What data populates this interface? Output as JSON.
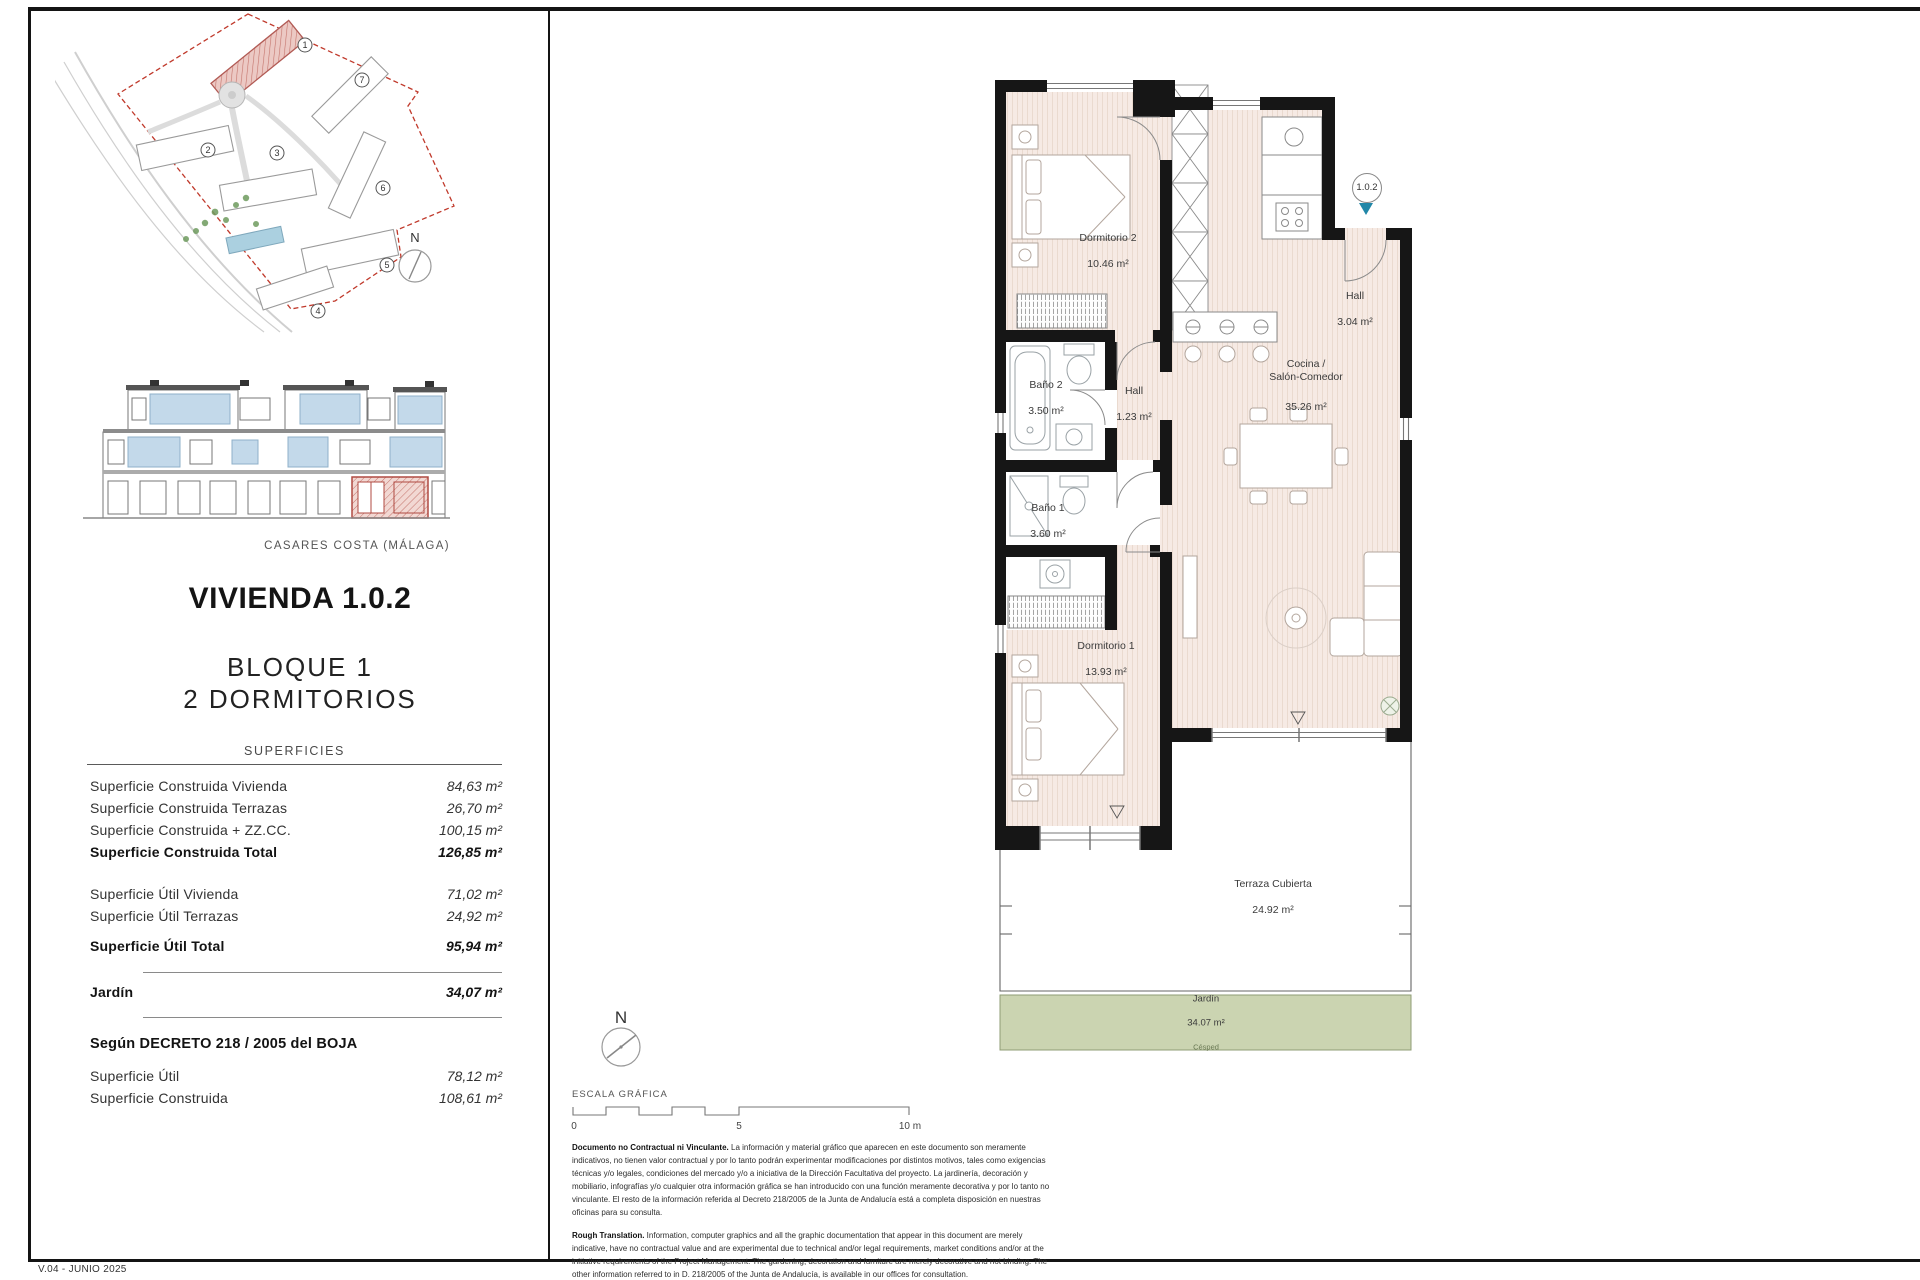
{
  "page": {
    "location": "CASARES COSTA (MÁLAGA)",
    "version": "V.04 - JUNIO 2025"
  },
  "title": {
    "unit": "VIVIENDA 1.0.2",
    "block": "BLOQUE 1",
    "type": "2 DORMITORIOS"
  },
  "surfaces": {
    "header": "SUPERFICIES",
    "construida": [
      {
        "label": "Superficie Construida Vivienda",
        "value": "84,63 m²"
      },
      {
        "label": "Superficie Construida Terrazas",
        "value": "26,70 m²"
      },
      {
        "label": "Superficie Construida + ZZ.CC.",
        "value": "100,15 m²"
      },
      {
        "label": "Superficie Construida Total",
        "value": "126,85 m²"
      }
    ],
    "util": [
      {
        "label": "Superficie Útil Vivienda",
        "value": "71,02 m²"
      },
      {
        "label": "Superficie Útil Terrazas",
        "value": "24,92 m²"
      },
      {
        "label": "Superficie Útil Total",
        "value": "95,94 m²"
      }
    ],
    "jardin": {
      "label": "Jardín",
      "value": "34,07 m²"
    },
    "decree": {
      "header": "Según DECRETO 218 / 2005 del BOJA",
      "rows": [
        {
          "label": "Superficie Útil",
          "value": "78,12 m²"
        },
        {
          "label": "Superficie Construida",
          "value": "108,61 m²"
        }
      ]
    }
  },
  "site_plan": {
    "north": "N",
    "numbers": [
      "1",
      "2",
      "3",
      "4",
      "5",
      "6",
      "7"
    ]
  },
  "floor_plan": {
    "marker": "1.0.2",
    "north": "N",
    "rooms": {
      "dormitorio2": {
        "name": "Dormitorio 2",
        "area": "10.46 m²"
      },
      "bano2": {
        "name": "Baño 2",
        "area": "3.50 m²"
      },
      "hall_inner": {
        "name": "Hall",
        "area": "1.23 m²"
      },
      "bano1": {
        "name": "Baño 1",
        "area": "3.60 m²"
      },
      "dormitorio1": {
        "name": "Dormitorio 1",
        "area": "13.93 m²"
      },
      "hall_entry": {
        "name": "Hall",
        "area": "3.04 m²"
      },
      "cocina": {
        "name": "Cocina /\nSalón-Comedor",
        "area": "35.26 m²"
      },
      "terraza": {
        "name": "Terraza Cubierta",
        "area": "24.92 m²"
      },
      "jardin": {
        "name": "Jardín",
        "area": "34.07 m²",
        "note": "Césped"
      }
    }
  },
  "scale_bar": {
    "label": "ESCALA GRÁFICA",
    "tick0": "0",
    "tick5": "5",
    "tick10": "10 m"
  },
  "disclaimer": {
    "es_lead": "Documento no Contractual ni Vinculante.",
    "es_body": " La información y material gráfico que aparecen en este documento son meramente indicativos, no tienen valor contractual y por lo tanto podrán experimentar modificaciones por distintos motivos, tales como exigencias técnicas y/o legales, condiciones del mercado y/o a iniciativa de la Dirección Facultativa del proyecto. La jardinería, decoración y mobiliario, infografías y/o cualquier otra información gráfica se han introducido con una función meramente decorativa y por lo tanto no vinculante. El resto de la información referida al Decreto 218/2005 de la Junta de Andalucía está a completa disposición en nuestras oficinas para su consulta.",
    "en_lead": "Rough Translation.",
    "en_body": " Information, computer graphics and all the graphic documentation that appear in this document are merely indicative, have no contractual value and are experimental due to technical and/or legal requirements, market conditions and/or at the initiative requirements of the Project Management. The gardening, decoration and furniture are merely decorative and not binding. The other information referred to in D. 218/2005 of the Junta de Andalucía, is available in our offices for consultation."
  },
  "colors": {
    "accent_red": "#b04a42",
    "plan_floor": "#f6eae4",
    "jardin_green": "#cbd4b1",
    "marker_teal": "#2187a8",
    "elevation_blue": "#c3d9ea"
  }
}
